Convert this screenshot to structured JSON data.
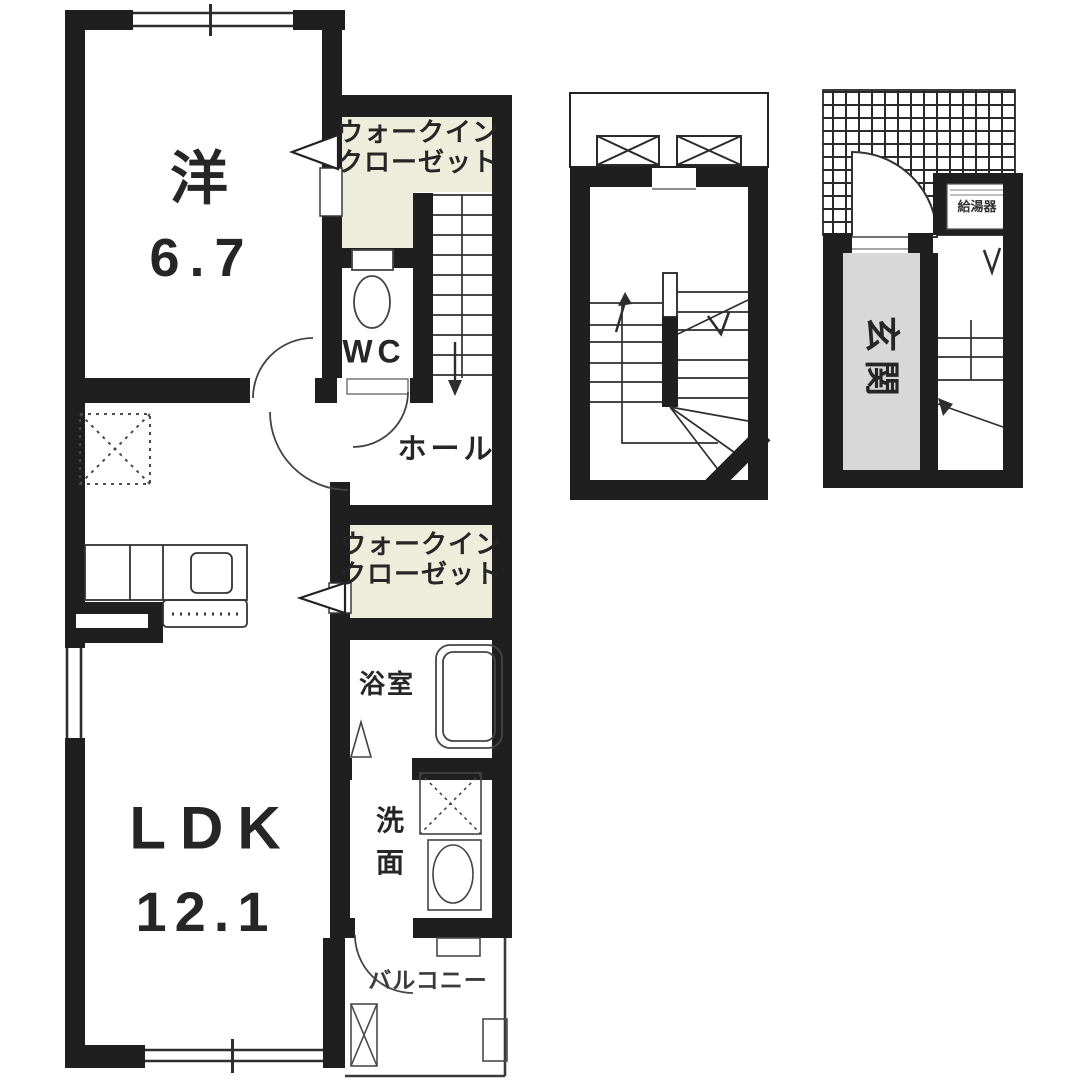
{
  "colors": {
    "wall": "#1f1f1f",
    "closet_fill": "#ededdc",
    "entrance_fill": "#d8d8d8",
    "line": "#3a3a3a",
    "text": "#262626",
    "background": "#ffffff"
  },
  "plan": {
    "unit": {
      "western_room": {
        "name": "洋",
        "area": "6.7"
      },
      "walk_in_closet_upper": {
        "line1": "ウォークイン",
        "line2": "クローゼット"
      },
      "toilet": {
        "label": "WC"
      },
      "hall": {
        "label": "ホール"
      },
      "walk_in_closet_lower": {
        "line1": "ウォークイン",
        "line2": "クローゼット"
      },
      "bathroom": {
        "label": "浴室"
      },
      "washroom": {
        "label": "洗面"
      },
      "ldk": {
        "name": "LDK",
        "area": "12.1"
      },
      "balcony": {
        "label": "バルコニー"
      }
    },
    "entrance_diagram": {
      "entrance": {
        "label": "玄関"
      },
      "utility_box": {
        "label": "給湯器"
      }
    }
  }
}
